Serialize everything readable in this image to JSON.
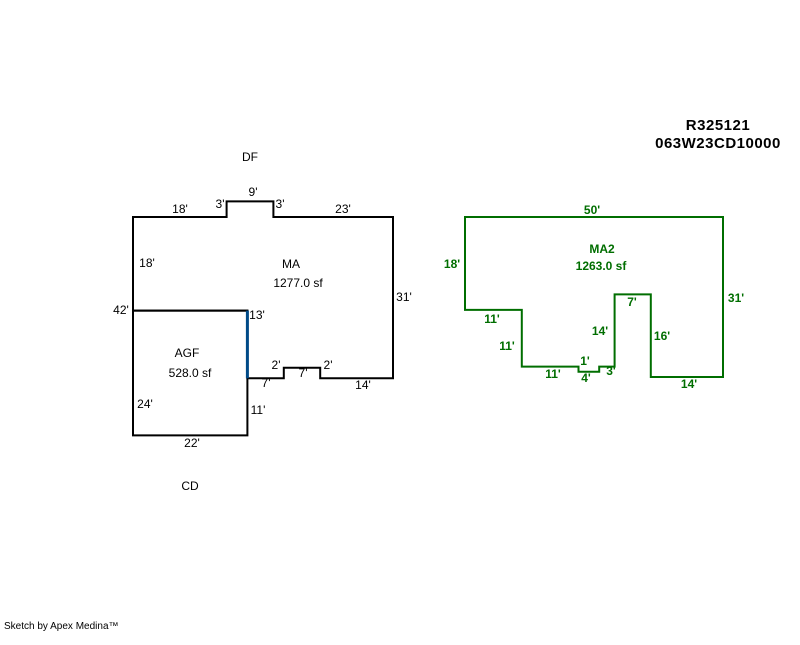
{
  "header": {
    "parcel_number": "R325121",
    "account_number": "063W23CD10000"
  },
  "footer": {
    "credit": "Sketch by Apex Medina™"
  },
  "colors": {
    "black": "#000000",
    "green": "#006e00",
    "blue": "#004a87"
  },
  "sketch": {
    "areas": [
      {
        "code": "MA",
        "size": "1277.0 sf"
      },
      {
        "code": "AGF",
        "size": "528.0 sf"
      },
      {
        "code": "MA2",
        "size": "1263.0 sf"
      }
    ],
    "polygons": [
      {
        "id": "ma-outline",
        "color": "black",
        "stroke_width": 2,
        "closed": true,
        "origin": [
          133,
          217
        ],
        "scale": 5.2,
        "points_ft": [
          [
            0,
            0
          ],
          [
            18,
            0
          ],
          [
            18,
            -3
          ],
          [
            27,
            -3
          ],
          [
            27,
            0
          ],
          [
            50,
            0
          ],
          [
            50,
            31
          ],
          [
            36,
            31
          ],
          [
            36,
            29
          ],
          [
            29,
            29
          ],
          [
            29,
            31
          ],
          [
            22,
            31
          ],
          [
            22,
            18
          ],
          [
            0,
            18
          ]
        ]
      },
      {
        "id": "agf-outline",
        "color": "black",
        "stroke_width": 2,
        "closed": true,
        "origin": [
          133,
          217
        ],
        "scale": 5.2,
        "points_ft": [
          [
            0,
            18
          ],
          [
            22,
            18
          ],
          [
            22,
            42
          ],
          [
            0,
            42
          ]
        ]
      },
      {
        "id": "ma2-outline",
        "color": "green",
        "stroke_width": 2,
        "closed": true,
        "origin": [
          465,
          217
        ],
        "scale": 5.16,
        "points_ft": [
          [
            0,
            0
          ],
          [
            50,
            0
          ],
          [
            50,
            31
          ],
          [
            36,
            31
          ],
          [
            36,
            15
          ],
          [
            29,
            15
          ],
          [
            29,
            29
          ],
          [
            26,
            29
          ],
          [
            26,
            30
          ],
          [
            22,
            30
          ],
          [
            22,
            29
          ],
          [
            11,
            29
          ],
          [
            11,
            18
          ],
          [
            0,
            18
          ]
        ]
      },
      {
        "id": "agf-ma-divider",
        "color": "blue",
        "stroke_width": 3,
        "closed": false,
        "origin": [
          133,
          217
        ],
        "scale": 5.2,
        "points_ft": [
          [
            22,
            18
          ],
          [
            22,
            31
          ]
        ]
      }
    ],
    "labels": [
      {
        "name": "annotation-label",
        "text": "DF",
        "x": 250,
        "y": 157,
        "color": "black",
        "bold": false
      },
      {
        "name": "dim-label",
        "text": "18'",
        "x": 180,
        "y": 209,
        "color": "black",
        "bold": false
      },
      {
        "name": "dim-label",
        "text": "3'",
        "x": 220,
        "y": 204,
        "color": "black",
        "bold": false
      },
      {
        "name": "dim-label",
        "text": "9'",
        "x": 253,
        "y": 192,
        "color": "black",
        "bold": false
      },
      {
        "name": "dim-label",
        "text": "3'",
        "x": 280,
        "y": 204,
        "color": "black",
        "bold": false
      },
      {
        "name": "dim-label",
        "text": "23'",
        "x": 343,
        "y": 209,
        "color": "black",
        "bold": false
      },
      {
        "name": "dim-label",
        "text": "18'",
        "x": 147,
        "y": 263,
        "color": "black",
        "bold": false
      },
      {
        "name": "dim-label",
        "text": "42'",
        "x": 121,
        "y": 310,
        "color": "black",
        "bold": false
      },
      {
        "name": "area-code-label",
        "text": "MA",
        "x": 291,
        "y": 264,
        "color": "black",
        "bold": false
      },
      {
        "name": "area-size-label",
        "text": "1277.0 sf",
        "x": 298,
        "y": 283,
        "color": "black",
        "bold": false
      },
      {
        "name": "dim-label",
        "text": "31'",
        "x": 404,
        "y": 297,
        "color": "black",
        "bold": false
      },
      {
        "name": "dim-label",
        "text": "13'",
        "x": 257,
        "y": 315,
        "color": "black",
        "bold": false
      },
      {
        "name": "area-code-label",
        "text": "AGF",
        "x": 187,
        "y": 353,
        "color": "black",
        "bold": false
      },
      {
        "name": "area-size-label",
        "text": "528.0 sf",
        "x": 190,
        "y": 373,
        "color": "black",
        "bold": false
      },
      {
        "name": "dim-label",
        "text": "2'",
        "x": 276,
        "y": 365,
        "color": "black",
        "bold": false
      },
      {
        "name": "dim-label",
        "text": "7'",
        "x": 303,
        "y": 373,
        "color": "black",
        "bold": false
      },
      {
        "name": "dim-label",
        "text": "2'",
        "x": 328,
        "y": 365,
        "color": "black",
        "bold": false
      },
      {
        "name": "dim-label",
        "text": "7'",
        "x": 266,
        "y": 383,
        "color": "black",
        "bold": false
      },
      {
        "name": "dim-label",
        "text": "14'",
        "x": 363,
        "y": 385,
        "color": "black",
        "bold": false
      },
      {
        "name": "dim-label",
        "text": "24'",
        "x": 145,
        "y": 404,
        "color": "black",
        "bold": false
      },
      {
        "name": "dim-label",
        "text": "11'",
        "x": 258,
        "y": 410,
        "color": "black",
        "bold": false
      },
      {
        "name": "dim-label",
        "text": "22'",
        "x": 192,
        "y": 443,
        "color": "black",
        "bold": false
      },
      {
        "name": "annotation-label",
        "text": "CD",
        "x": 190,
        "y": 486,
        "color": "black",
        "bold": false
      },
      {
        "name": "dim-label",
        "text": "50'",
        "x": 592,
        "y": 210,
        "color": "green",
        "bold": true
      },
      {
        "name": "area-code-label",
        "text": "MA2",
        "x": 602,
        "y": 249,
        "color": "green",
        "bold": true
      },
      {
        "name": "area-size-label",
        "text": "1263.0 sf",
        "x": 601,
        "y": 266,
        "color": "green",
        "bold": true
      },
      {
        "name": "dim-label",
        "text": "18'",
        "x": 452,
        "y": 264,
        "color": "green",
        "bold": true
      },
      {
        "name": "dim-label",
        "text": "11'",
        "x": 492,
        "y": 319,
        "color": "green",
        "bold": true
      },
      {
        "name": "dim-label",
        "text": "11'",
        "x": 507,
        "y": 346,
        "color": "green",
        "bold": true
      },
      {
        "name": "dim-label",
        "text": "11'",
        "x": 553,
        "y": 374,
        "color": "green",
        "bold": true
      },
      {
        "name": "dim-label",
        "text": "1'",
        "x": 585,
        "y": 361,
        "color": "green",
        "bold": true
      },
      {
        "name": "dim-label",
        "text": "4'",
        "x": 586,
        "y": 378,
        "color": "green",
        "bold": true
      },
      {
        "name": "dim-label",
        "text": "3'",
        "x": 611,
        "y": 371,
        "color": "green",
        "bold": true
      },
      {
        "name": "dim-label",
        "text": "14'",
        "x": 600,
        "y": 331,
        "color": "green",
        "bold": true
      },
      {
        "name": "dim-label",
        "text": "7'",
        "x": 632,
        "y": 302,
        "color": "green",
        "bold": true
      },
      {
        "name": "dim-label",
        "text": "16'",
        "x": 662,
        "y": 336,
        "color": "green",
        "bold": true
      },
      {
        "name": "dim-label",
        "text": "31'",
        "x": 736,
        "y": 298,
        "color": "green",
        "bold": true
      },
      {
        "name": "dim-label",
        "text": "14'",
        "x": 689,
        "y": 384,
        "color": "green",
        "bold": true
      }
    ]
  }
}
